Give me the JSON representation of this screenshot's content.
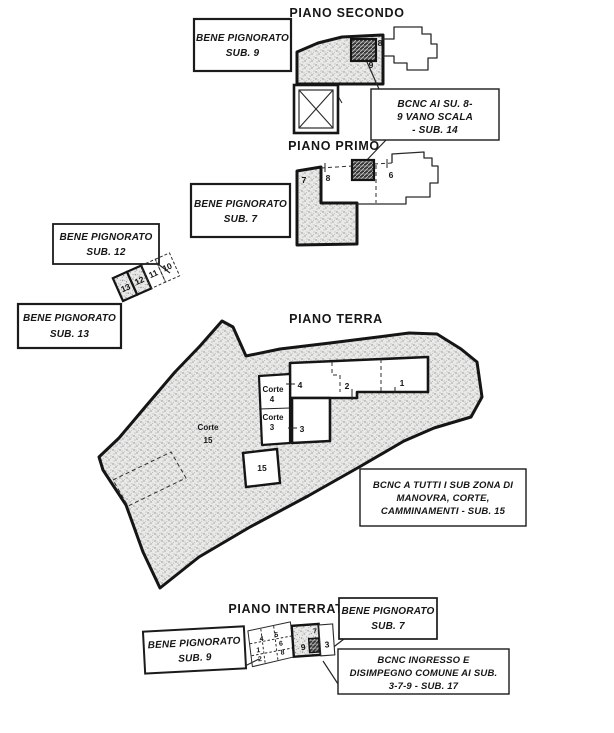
{
  "titles": {
    "secondo": "PIANO SECONDO",
    "primo": "PIANO PRIMO",
    "terra": "PIANO TERRA",
    "interrato": "PIANO INTERRATO"
  },
  "boxes": {
    "sub9_secondo": {
      "l1": "BENE PIGNORATO",
      "l2": "SUB. 9"
    },
    "bcnc_scala": {
      "l1": "BCNC AI SU. 8-",
      "l2": "9 VANO SCALA",
      "l3": "- SUB. 14"
    },
    "sub7_primo": {
      "l1": "BENE PIGNORATO",
      "l2": "SUB. 7"
    },
    "sub12": {
      "l1": "BENE PIGNORATO",
      "l2": "SUB. 12"
    },
    "sub13": {
      "l1": "BENE PIGNORATO",
      "l2": "SUB. 13"
    },
    "bcnc_terra": {
      "l1": "BCNC A TUTTI I SUB ZONA DI",
      "l2": "MANOVRA, CORTE,",
      "l3": "CAMMINAMENTI - SUB. 15"
    },
    "sub7_interrato": {
      "l1": "BENE PIGNORATO",
      "l2": "SUB. 7"
    },
    "sub9_interrato": {
      "l1": "BENE PIGNORATO",
      "l2": "SUB. 9"
    },
    "bcnc_ingresso": {
      "l1": "BCNC INGRESSO E",
      "l2": "DISIMPEGNO COMUNE AI SUB.",
      "l3": "3-7-9 - SUB. 17"
    }
  },
  "plan_labels": {
    "secondo": {
      "stair": "8",
      "unit": "9"
    },
    "primo": {
      "seized": "7",
      "left": "8",
      "right": "6"
    },
    "garage": {
      "g13": "13",
      "g12": "12",
      "g11": "11",
      "g10": "10"
    },
    "terra": {
      "u4": "4",
      "u2": "2",
      "u1": "1",
      "u3": "3",
      "corte4_a": "Corte",
      "corte4_b": "4",
      "corte3_a": "Corte",
      "corte3_b": "3",
      "corte15_a": "Corte",
      "corte15_b": "15",
      "square15": "15"
    },
    "interrato": {
      "c4": "4",
      "c5": "5",
      "c1": "1",
      "c2": "2",
      "c6": "6",
      "c8": "8",
      "c9": "9",
      "c3": "3",
      "c7": "7"
    }
  },
  "colors": {
    "ink": "#1b1b1b",
    "paper": "#ffffff"
  }
}
